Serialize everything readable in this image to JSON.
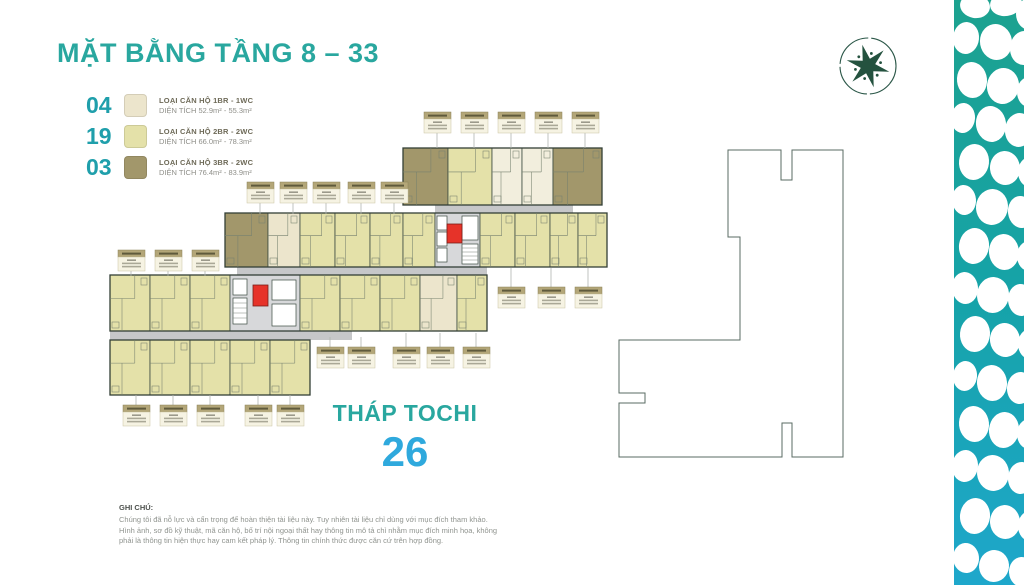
{
  "header": {
    "title": "MẶT BẰNG TẦNG 8 – 33"
  },
  "legend": {
    "items": [
      {
        "count": "04",
        "type_label": "LOẠI CĂN HỘ 1BR - 1WC",
        "area_label": "DIỆN TÍCH 52.9m² - 55.3m²",
        "swatch_color": "#ece5cc"
      },
      {
        "count": "19",
        "type_label": "LOẠI CĂN HỘ 2BR - 2WC",
        "area_label": "DIỆN TÍCH 66.0m² - 78.3m²",
        "swatch_color": "#e4e1a9"
      },
      {
        "count": "03",
        "type_label": "LOẠI CĂN HỘ 3BR - 2WC",
        "area_label": "DIỆN TÍCH 76.4m² - 83.9m²",
        "swatch_color": "#a2976b"
      }
    ]
  },
  "tower": {
    "name": "THÁP TOCHI",
    "floor_number": "26"
  },
  "notes": {
    "heading": "GHI CHÚ:",
    "line1": "Chúng tôi đã nỗ lực và cẩn trọng để hoàn thiện tài liệu này. Tuy nhiên tài liệu chỉ dùng với mục đích tham khảo.",
    "line2": "Hình ảnh, sơ đồ kỹ thuật, mã căn hộ, bố trí nội ngoại thất hay thông tin mô tả chỉ nhằm mục đích minh họa, không",
    "line3": "phải là thông tin hiện thực hay cam kết pháp lý. Thông tin chính thức được căn cứ trên hợp đồng."
  },
  "colors": {
    "accent_teal": "#29a79f",
    "floor_number_blue": "#2fa9dd",
    "unit_1br": "#ece5cc",
    "unit_2br": "#e4e1a9",
    "unit_3br": "#a2976b",
    "corridor_grey": "#c6c7c9",
    "elevator_red": "#e63329",
    "pattern_teal_top": "#1ca28f",
    "pattern_teal_bottom": "#1ea7cb"
  }
}
